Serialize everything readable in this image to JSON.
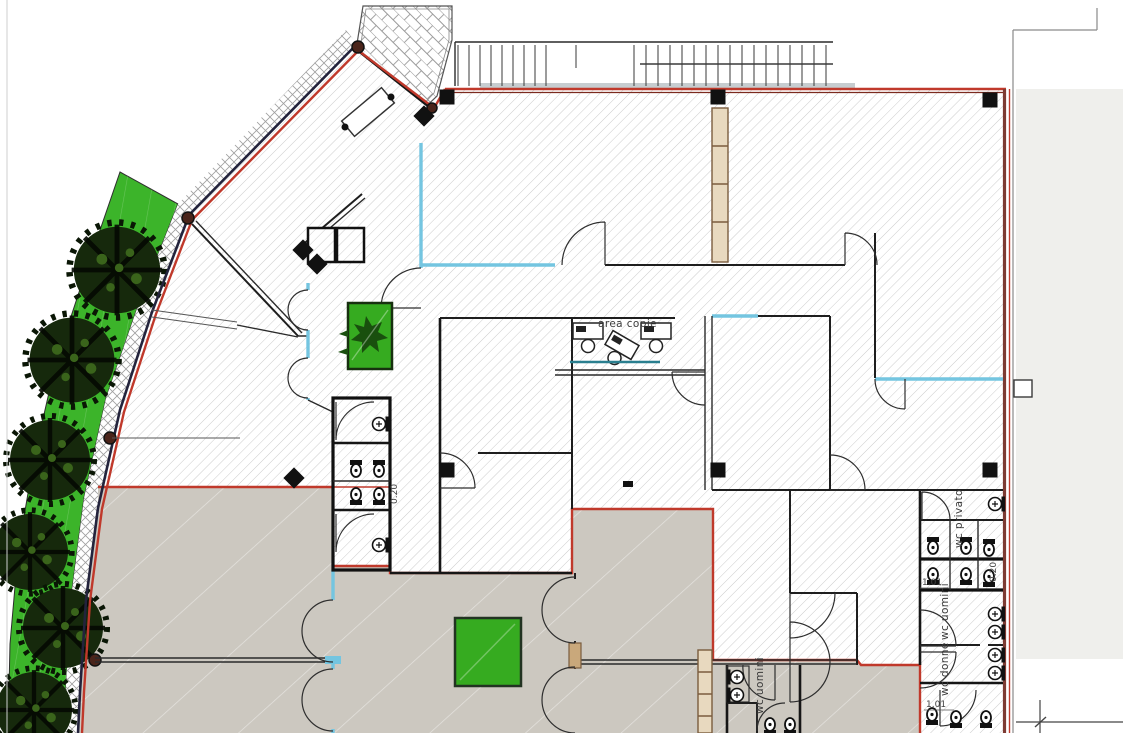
{
  "drawing": {
    "type": "architectural-floor-plan",
    "labels": {
      "area_copie": "area copie",
      "wc_privato": "wc privato",
      "wc_uomini_right": "wc uomini",
      "wc_donne": "wc donne",
      "wc_uomini_bottom": "wc uomini",
      "dim_101_right": "1.01",
      "dim_020_right": "0.20",
      "dim_101_bottom": "1.01",
      "dim_020_mid": "0.20"
    },
    "colors": {
      "lawn": "#3cb42a",
      "planter": "#36ab20",
      "floor_gray": "#ccc8c0",
      "red": "#c0392b",
      "maroon": "#7d3b33",
      "navy": "#23233c",
      "cyan": "#74c5e0",
      "wood": "#c9a87b",
      "offwhite": "#efefec",
      "stairband": "#b9c0c4",
      "tree": "#16290c"
    }
  }
}
